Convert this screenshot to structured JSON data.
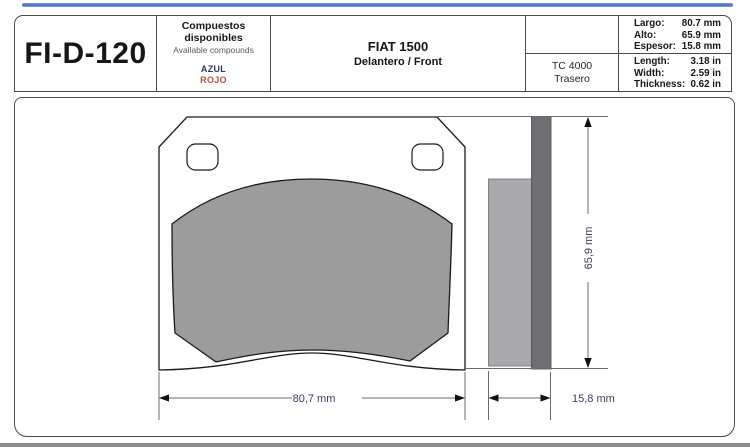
{
  "header": {
    "product_code": "FI-D-120",
    "compounds": {
      "title": "Compuestos disponibles",
      "subtitle": "Available compounds",
      "options": [
        {
          "name": "AZUL",
          "color": "#32326b"
        },
        {
          "name": "ROJO",
          "color": "#b5503c"
        }
      ]
    },
    "application": {
      "vehicle": "FIAT 1500",
      "position": "Delantero / Front"
    },
    "counterpart": {
      "code": "TC 4000",
      "position": "Trasero"
    },
    "dimensions_metric": {
      "rows": [
        {
          "label": "Largo:",
          "value": "80.7 mm"
        },
        {
          "label": "Alto:",
          "value": "65.9 mm"
        },
        {
          "label": "Espesor:",
          "value": "15.8 mm"
        }
      ]
    },
    "dimensions_imperial": {
      "rows": [
        {
          "label": "Length:",
          "value": "3.18 in"
        },
        {
          "label": "Width:",
          "value": "2.59 in"
        },
        {
          "label": "Thickness:",
          "value": "0.62 in"
        }
      ]
    }
  },
  "drawing": {
    "width_dim": "80,7 mm",
    "height_dim": "65,9 mm",
    "thickness_dim": "15,8 mm"
  },
  "colors": {
    "accent_line": "#5b80d4",
    "friction_front": "#9c9c9c",
    "friction_side": "#a9a9ad",
    "backplate_side": "#6f6f73",
    "dim_text": "#394067"
  }
}
